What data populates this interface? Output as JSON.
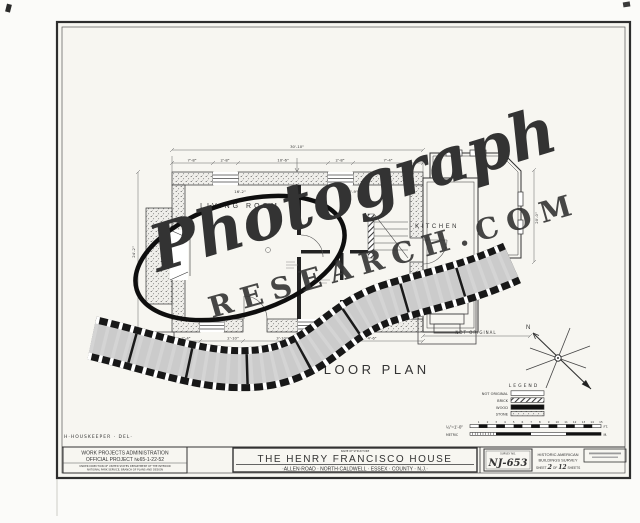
{
  "watermark": {
    "script_text": "Photograph",
    "caps_text": "RESEARCH.COM"
  },
  "plan": {
    "title": "FIRST FLOOR PLAN",
    "room_living": "LIVING ROOM",
    "room_kitchen": "KITCHEN",
    "not_original": "NOT ORIGINAL",
    "north_label": "N",
    "dim_overall": "30'-10\"",
    "dims_top": [
      "7'-8\"",
      "2'-8\"",
      "10'-6\"",
      "2'-8\"",
      "7'-4\""
    ],
    "dims_interior": [
      "16'-2\"",
      "14'-9\""
    ],
    "dims_bottom": [
      "2'-4\"",
      "2'-10\"",
      "3'-10\"",
      "4'-6\""
    ],
    "dim_right": "20'-0\"",
    "dim_left": "24'-2\""
  },
  "legend": {
    "title": "LEGEND",
    "items": [
      "NOT ORIGINAL",
      "BRICK",
      "WOOD",
      "STONE"
    ]
  },
  "scale": {
    "ratio": "¼\"=1'-0\"",
    "feet_unit": "FT.",
    "metric_label": "METRIC",
    "metric_unit": "M.",
    "ticks": [
      "1",
      "2",
      "3",
      "4",
      "5",
      "6",
      "7",
      "8",
      "9",
      "10",
      "11",
      "12",
      "13",
      "14",
      "15"
    ]
  },
  "title_block": {
    "delineator": "H·HOUSKEEPER · DEL·",
    "wpa_line1": "WORK PROJECTS ADMINISTRATION",
    "wpa_line2": "OFFICIAL PROJECT №65-1-22-52",
    "wpa_line3": "UNDER DIRECTION OF UNITED STATES DEPARTMENT OF THE INTERIOR",
    "wpa_line4": "NATIONAL PARK SERVICE, BRANCH OF PLANS AND DESIGN",
    "name_of_structure_label": "NAME OF STRUCTURE",
    "structure_name": "THE HENRY FRANCISCO HOUSE",
    "structure_address": "·ALLEN·ROAD · NORTH·CALDWELL · ESSEX · COUNTY · N.J.·",
    "survey_no_label": "SURVEY NO.",
    "survey_no": "NJ-653",
    "habs_line1": "HISTORIC AMERICAN",
    "habs_line2": "BUILDINGS SURVEY",
    "sheet_word": "SHEET",
    "sheet_num": "2",
    "of_word": "OF",
    "total_num": "12",
    "sheets_word": "SHEETS"
  }
}
